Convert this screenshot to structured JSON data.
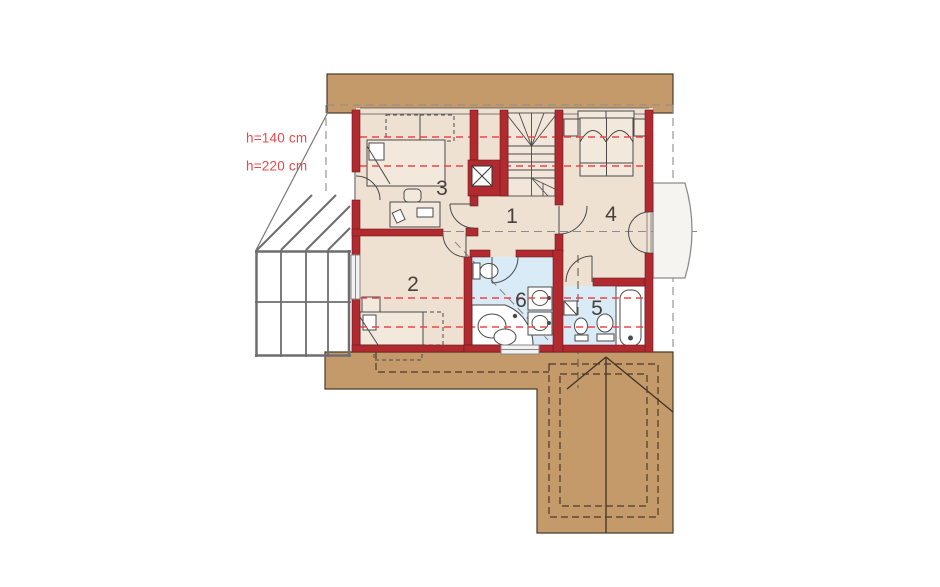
{
  "plan": {
    "annotations": [
      {
        "id": "h140",
        "label": "h=140 cm"
      },
      {
        "id": "h220",
        "label": "h=220 cm"
      }
    ],
    "rooms": [
      {
        "number": "1"
      },
      {
        "number": "2"
      },
      {
        "number": "3"
      },
      {
        "number": "4"
      },
      {
        "number": "5"
      },
      {
        "number": "6"
      }
    ],
    "colors": {
      "wall_red": "#b02a30",
      "roof_brown": "#c59a6b",
      "roof_outline": "#4a3a28",
      "floor_beige": "#efe1d2",
      "bathroom_blue": "#d9ebf7",
      "height_line_red": "#e8484d",
      "line_gray": "#8c8c8c"
    }
  }
}
